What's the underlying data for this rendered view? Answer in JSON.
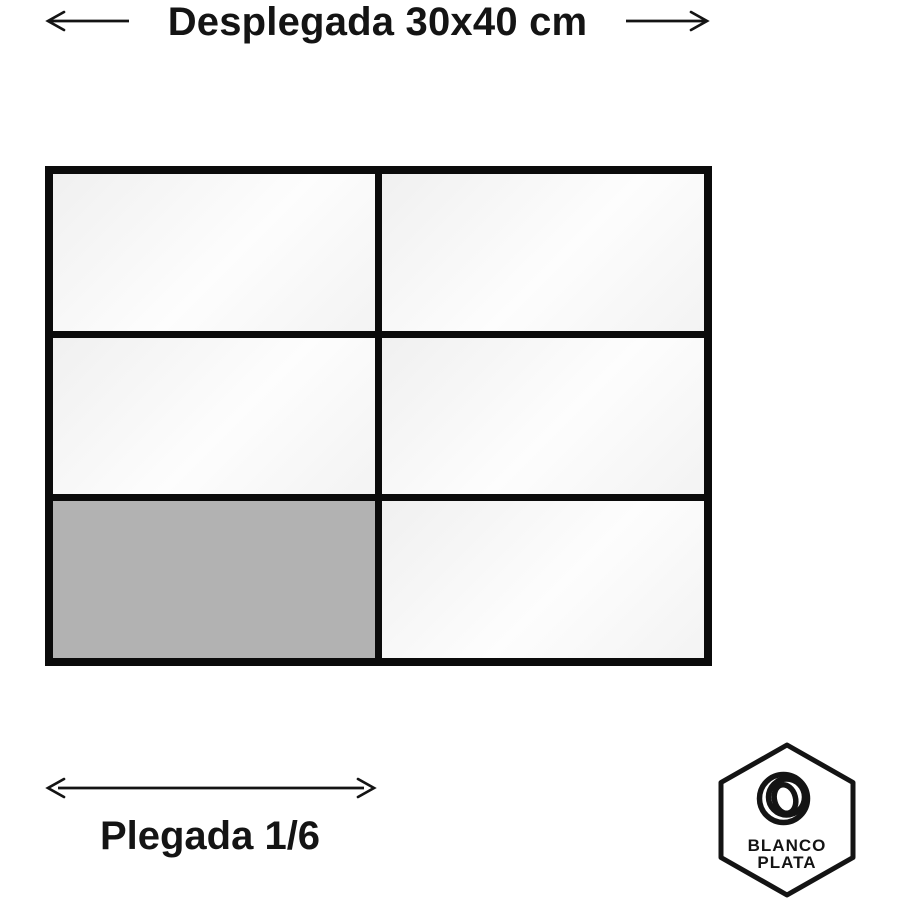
{
  "title": {
    "label": "Desplegada 30x40 cm"
  },
  "folded": {
    "label": "Plegada 1/6"
  },
  "diagram": {
    "rows": 3,
    "cols": 2,
    "unfolded_size_cm": "30x40",
    "folded_fraction": "1/6",
    "cells": [
      {
        "row": 1,
        "col": 1,
        "highlighted": false
      },
      {
        "row": 1,
        "col": 2,
        "highlighted": false
      },
      {
        "row": 2,
        "col": 1,
        "highlighted": false
      },
      {
        "row": 2,
        "col": 2,
        "highlighted": false
      },
      {
        "row": 3,
        "col": 1,
        "highlighted": true
      },
      {
        "row": 3,
        "col": 2,
        "highlighted": false
      }
    ]
  },
  "logo": {
    "line1": "BLANCO",
    "line2": "PLATA"
  },
  "colors": {
    "ink": "#141414",
    "border": "#0b0b0b",
    "highlight": "#b2b2b2",
    "cell-start": "#f0f0f0",
    "cell-mid": "#fdfdfd",
    "cell-end": "#f3f3f3",
    "background": "#ffffff"
  }
}
